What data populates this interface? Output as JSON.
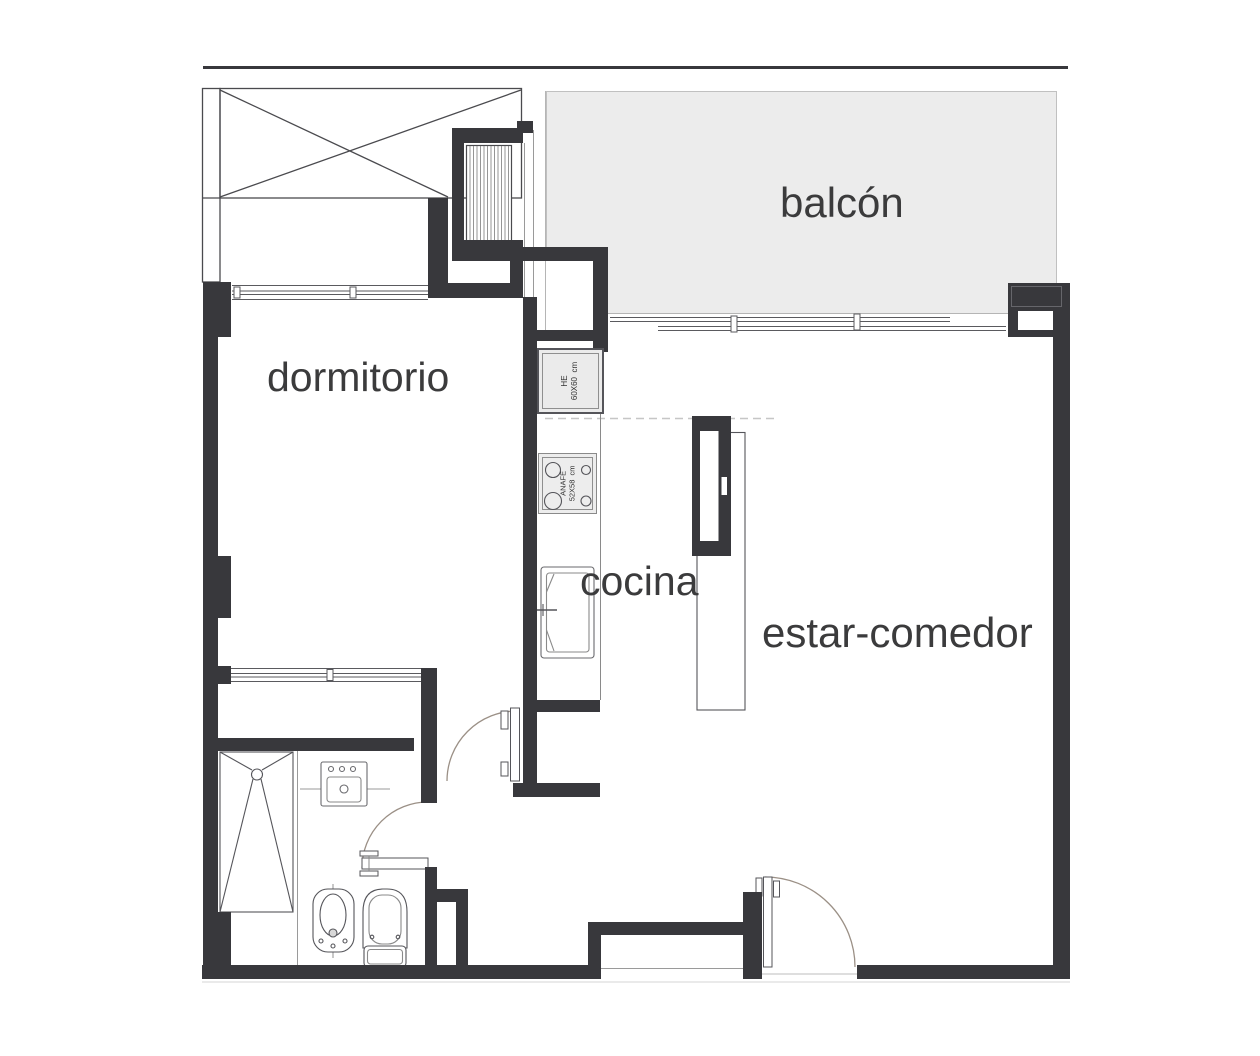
{
  "plan": {
    "type": "apartment-floor-plan",
    "rooms": {
      "bedroom": {
        "label": "dormitorio"
      },
      "balcony": {
        "label": "balcón"
      },
      "kitchen": {
        "label": "cocina"
      },
      "living_dining": {
        "label": "estar-comedor"
      }
    },
    "appliances": {
      "refrigerator": {
        "line1": "HE",
        "line2": "60X60  cm"
      },
      "cooktop": {
        "line1": "ANAFE",
        "line2": "52X58  cm"
      }
    },
    "fixtures": [
      "shower",
      "washbasin",
      "bidet",
      "toilet",
      "kitchen-sink",
      "island-counter",
      "wardrobe",
      "duct-shaft"
    ],
    "colors": {
      "wall": "#38383c",
      "balcony_floor": "#ececec",
      "appliance_fill": "#ededed",
      "label_text": "#3b3b3c",
      "thin_line": "#555555",
      "door_arc": "#9b9086"
    }
  }
}
